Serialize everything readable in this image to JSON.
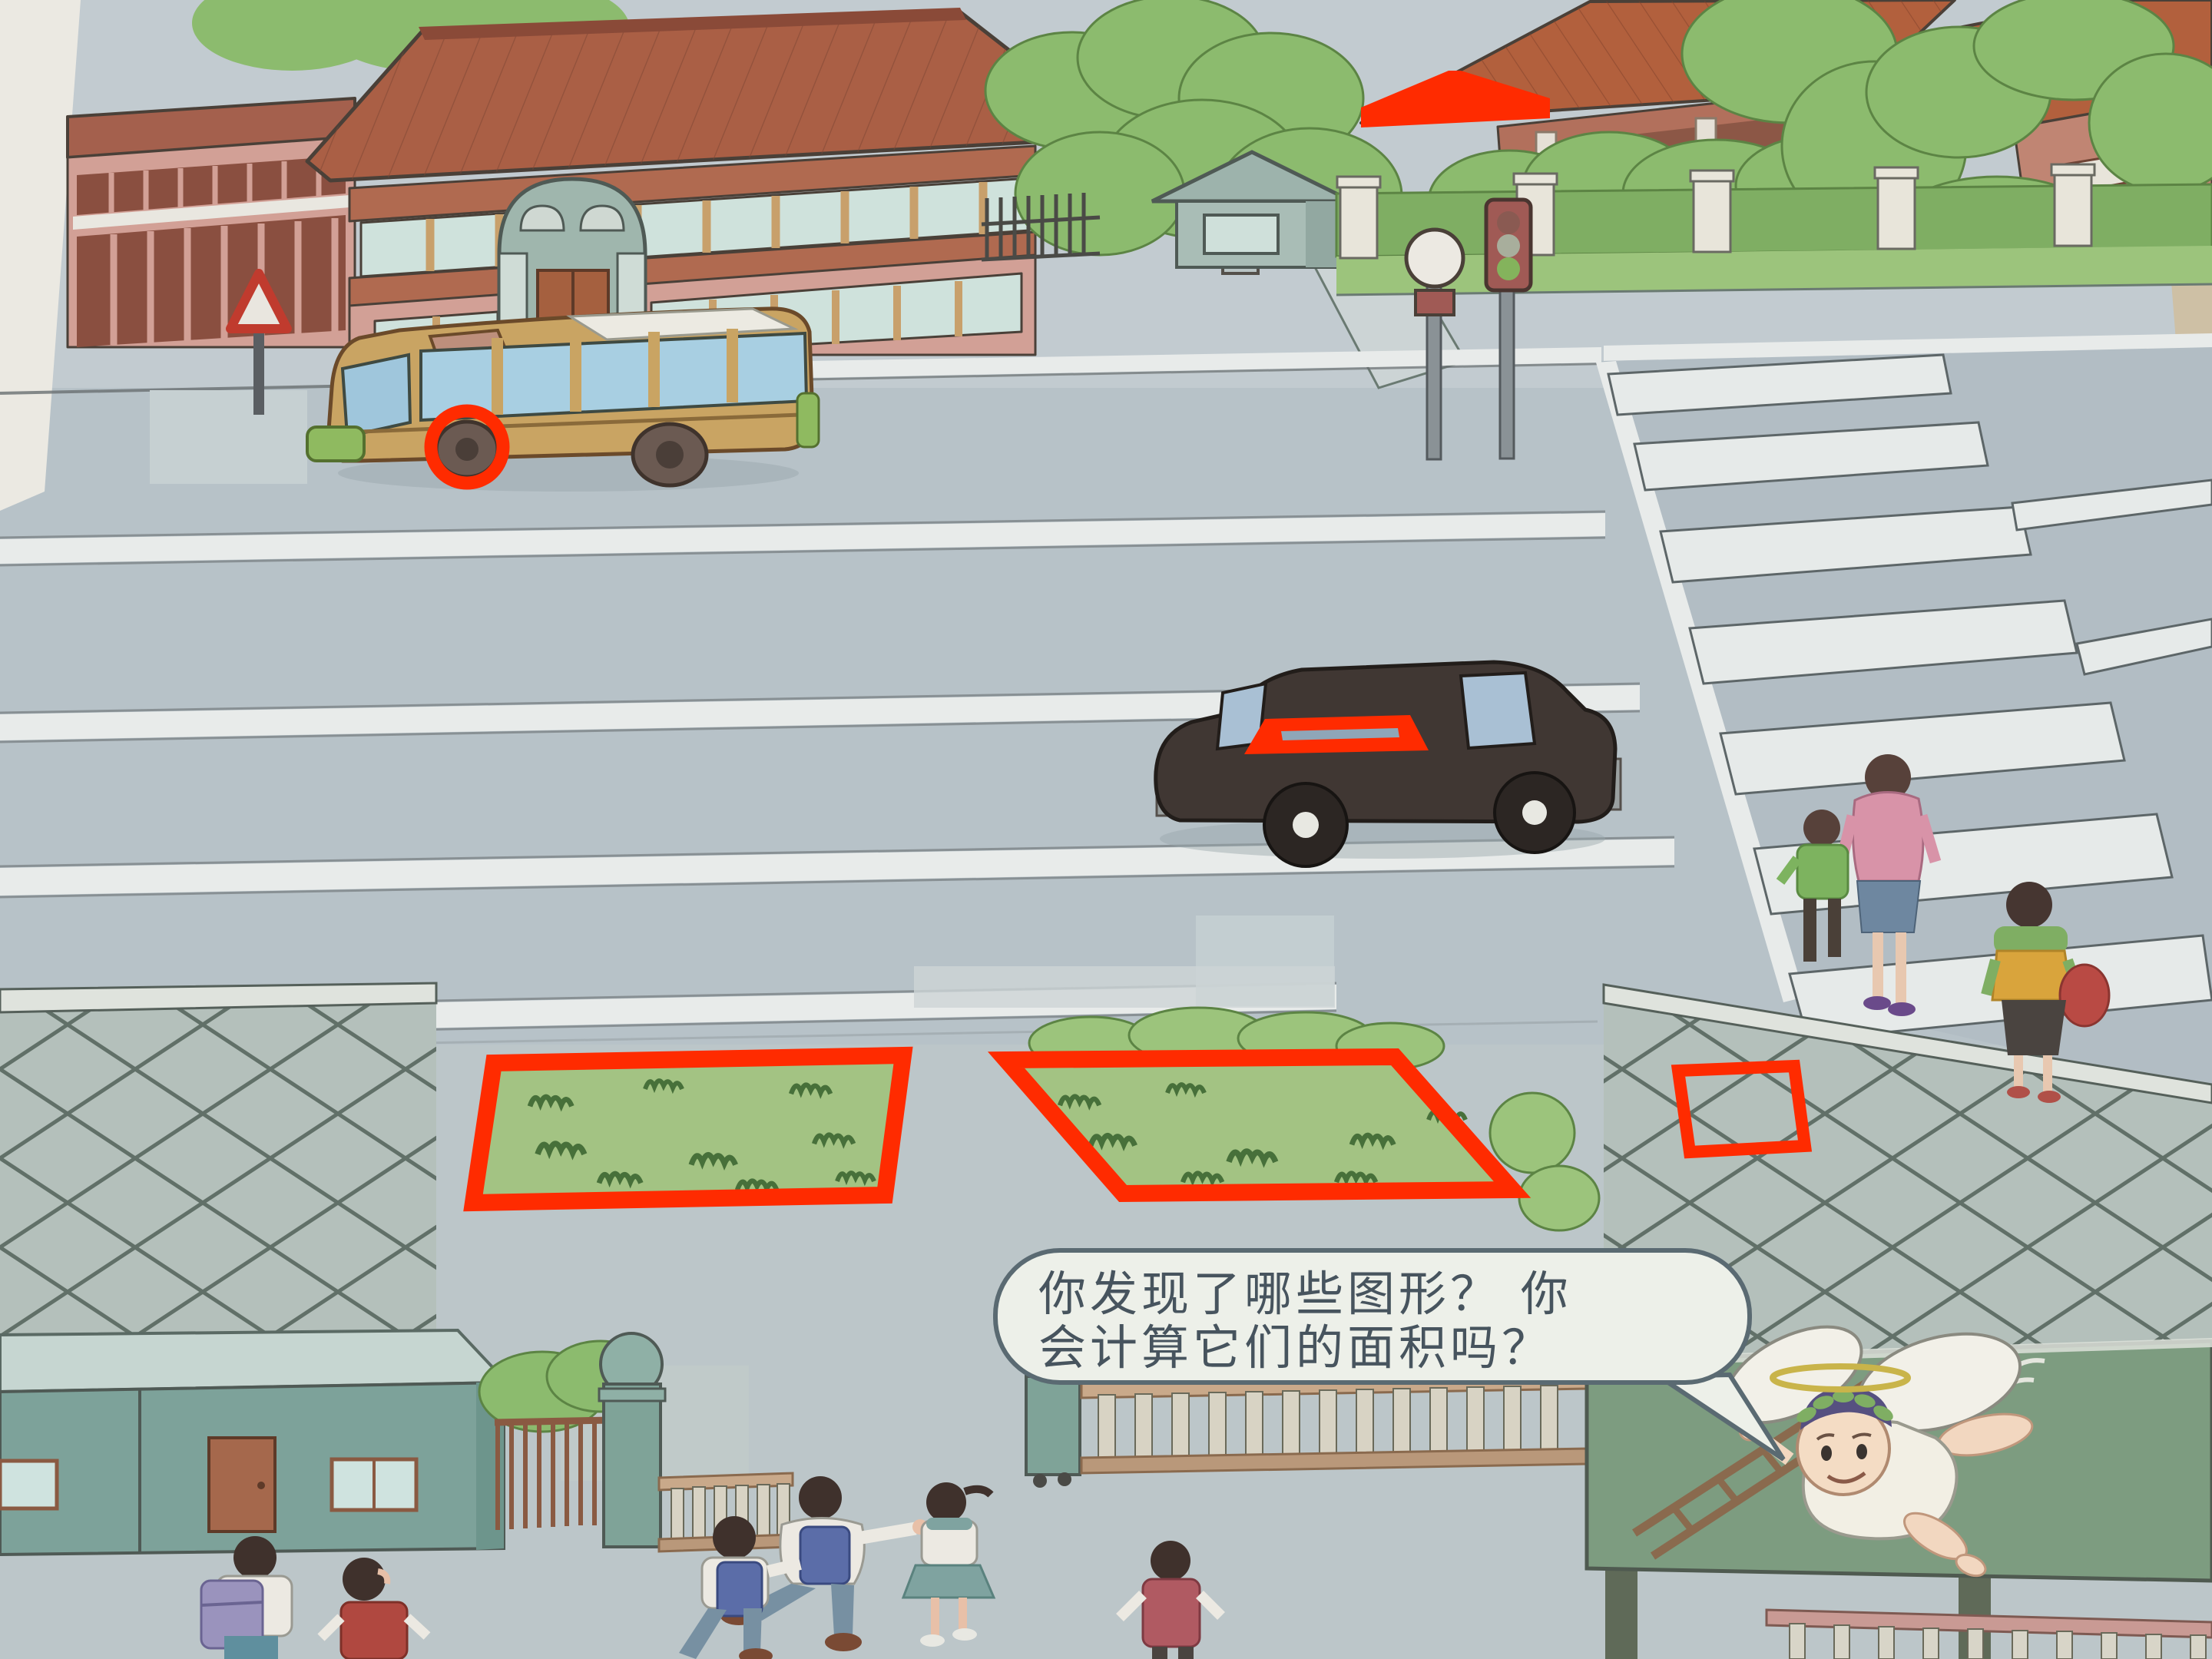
{
  "page_kind": "textbook illustration page",
  "speech_bubble": {
    "line1": "你发现了哪些图形？ 你",
    "line2": "会计算它们的面积吗？"
  },
  "annotations": {
    "color": "#ff2b00",
    "shapes": [
      {
        "shape": "circle",
        "on": "bus-front-wheel"
      },
      {
        "shape": "trapezoid",
        "on": "house-roof-gable"
      },
      {
        "shape": "parallelogram",
        "on": "car-door-window"
      },
      {
        "shape": "rectangle",
        "on": "left-grass-plot"
      },
      {
        "shape": "parallelogram",
        "on": "right-grass-plot"
      },
      {
        "shape": "square",
        "on": "lattice-fence-panel"
      }
    ]
  },
  "scene": {
    "traffic_light_state": "green",
    "colors": {
      "road": "#b2bdc4",
      "sidewalk": "#c2cbd0",
      "grass": "#a3c383",
      "hedge": "#8cbb6e",
      "school_wall": "#d2a096",
      "roof": "#aa5f45",
      "bus_body": "#c9a463",
      "car_body": "#403733",
      "billboard": "#7d9c80",
      "lattice_wall": "#b4c0bb"
    }
  }
}
